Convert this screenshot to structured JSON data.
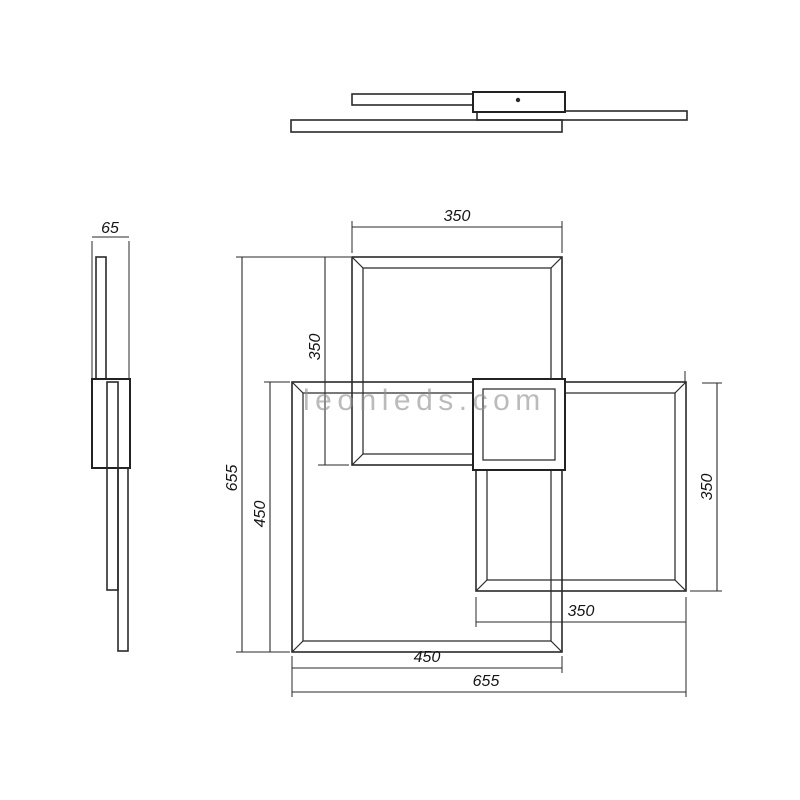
{
  "watermark": {
    "text": "leonleds.com",
    "color": "#8f8f8f"
  },
  "drawing": {
    "type": "technical-dimension-drawing",
    "subject": "LED ceiling lamp with three overlapping square frames",
    "line_color": "#2a2a2a",
    "views": {
      "front_elevation": "fixture seen from front (stacked frame bars and canopy)",
      "side_elevation": "fixture seen from side with depth dimension",
      "plan_view": "three overlapping square frames with central canopy"
    },
    "dimensions": {
      "depth": "65",
      "top_frame_width": "350",
      "top_frame_height": "350",
      "overall_height": "655",
      "left_frame_height": "450",
      "right_frame_height": "350",
      "right_frame_width": "350",
      "left_frame_width": "450",
      "overall_width": "655"
    }
  }
}
